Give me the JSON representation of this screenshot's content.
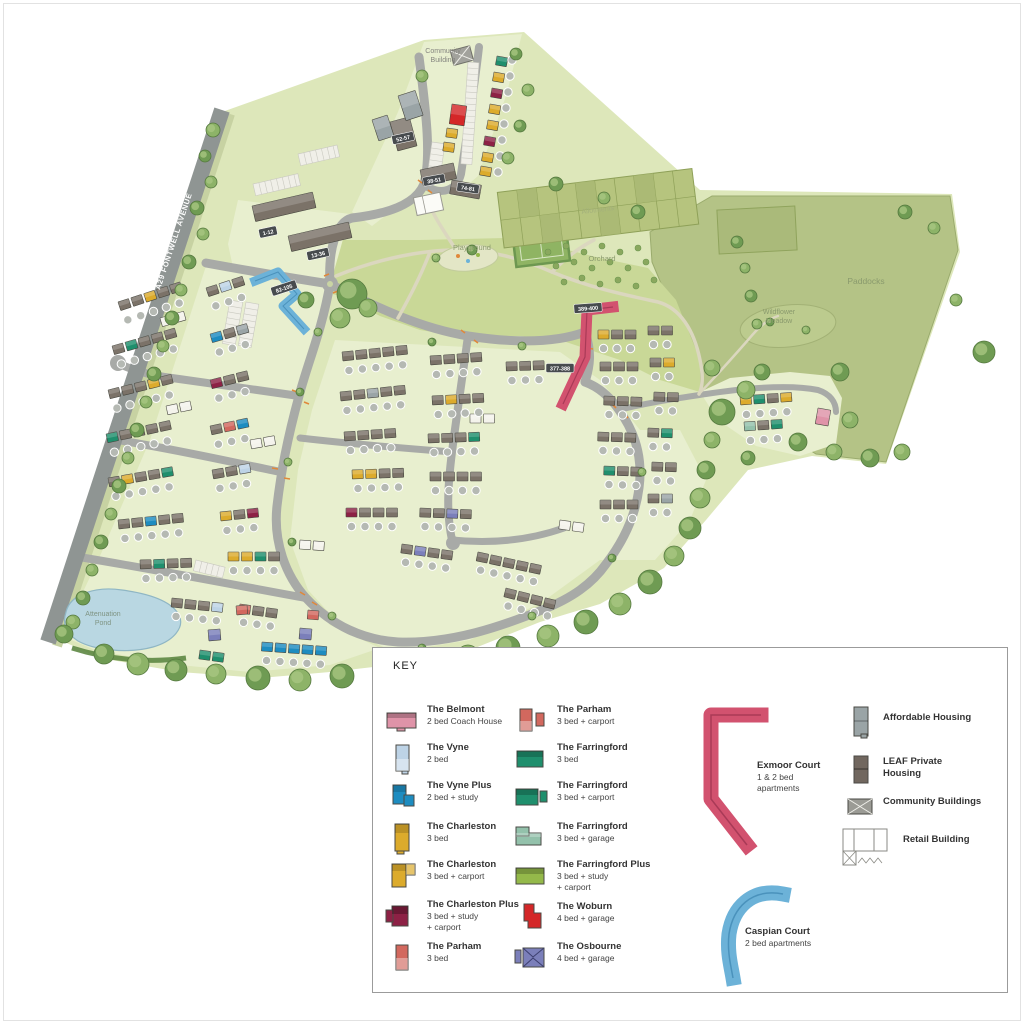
{
  "map": {
    "road_label": "A29 FONTWELL AVENUE",
    "labels": {
      "community_building": "Community\nBuilding",
      "playground": "Playground",
      "orchard": "Orchard",
      "allotments": "Allotments",
      "paddocks": "Paddocks",
      "wildflower_meadow": "Wildflower\nMeadow",
      "attenuation_pond": "Attenuation\nPond"
    },
    "badges": [
      "1-12",
      "13-36",
      "38-51",
      "52-57",
      "74-81",
      "82-105",
      "377-388",
      "389-400"
    ]
  },
  "legend": {
    "title": "KEY",
    "items": [
      {
        "name": "The Belmont",
        "desc": "2 bed Coach House",
        "color": "#df93a8"
      },
      {
        "name": "The Vyne",
        "desc": "2 bed",
        "color": "#bdd3e6"
      },
      {
        "name": "The Vyne Plus",
        "desc": "2 bed + study",
        "color": "#1d8cc0"
      },
      {
        "name": "The Charleston",
        "desc": "3 bed",
        "color": "#dcab2c"
      },
      {
        "name": "The Charleston",
        "desc": "3 bed + carport",
        "color": "#dcab2c"
      },
      {
        "name": "The Charleston Plus",
        "desc": "3 bed + study\n+ carport",
        "color": "#8d2145"
      },
      {
        "name": "The Parham",
        "desc": "3 bed",
        "color": "#d2685e"
      },
      {
        "name": "The Parham",
        "desc": "3 bed + carport",
        "color": "#d2685e"
      },
      {
        "name": "The Farringford",
        "desc": "3 bed",
        "color": "#1f8f6d"
      },
      {
        "name": "The Farringford",
        "desc": "3 bed + carport",
        "color": "#1f8f6d"
      },
      {
        "name": "The Farringford",
        "desc": "3 bed + garage",
        "color": "#93c1ab"
      },
      {
        "name": "The Farringford Plus",
        "desc": "3 bed + study\n+ carport",
        "color": "#94b94a"
      },
      {
        "name": "The Woburn",
        "desc": "4 bed + garage",
        "color": "#d42728"
      },
      {
        "name": "The Osbourne",
        "desc": "4 bed + garage",
        "color": "#7b7fba"
      },
      {
        "name": "Exmoor Court",
        "desc": "1 & 2 bed\napartments",
        "color": "#d2526f"
      },
      {
        "name": "Caspian Court",
        "desc": "2 bed apartments",
        "color": "#6cb2d8"
      },
      {
        "name": "Affordable Housing",
        "desc": "",
        "color": "#9aa4a6"
      },
      {
        "name": "LEAF Private\nHousing",
        "desc": "",
        "color": "#71675f"
      },
      {
        "name": "Community Buildings",
        "desc": "",
        "color": "#9b9b95"
      },
      {
        "name": "Retail Building",
        "desc": "",
        "color": "#ffffff"
      }
    ]
  },
  "colors": {
    "site": "#dde7ba",
    "plots": "#e8efcf",
    "park": "#c9d897",
    "paddocks": "#b4c386",
    "allotments": "#b6c47e",
    "pond": "#b9d7e2",
    "road": "#a8aaa7",
    "main_road": "#8f9593",
    "path": "#dbd7bf",
    "tree_dark": "#6f9b53",
    "tree_light": "#8db368",
    "leaf_house": "#7b7268"
  }
}
